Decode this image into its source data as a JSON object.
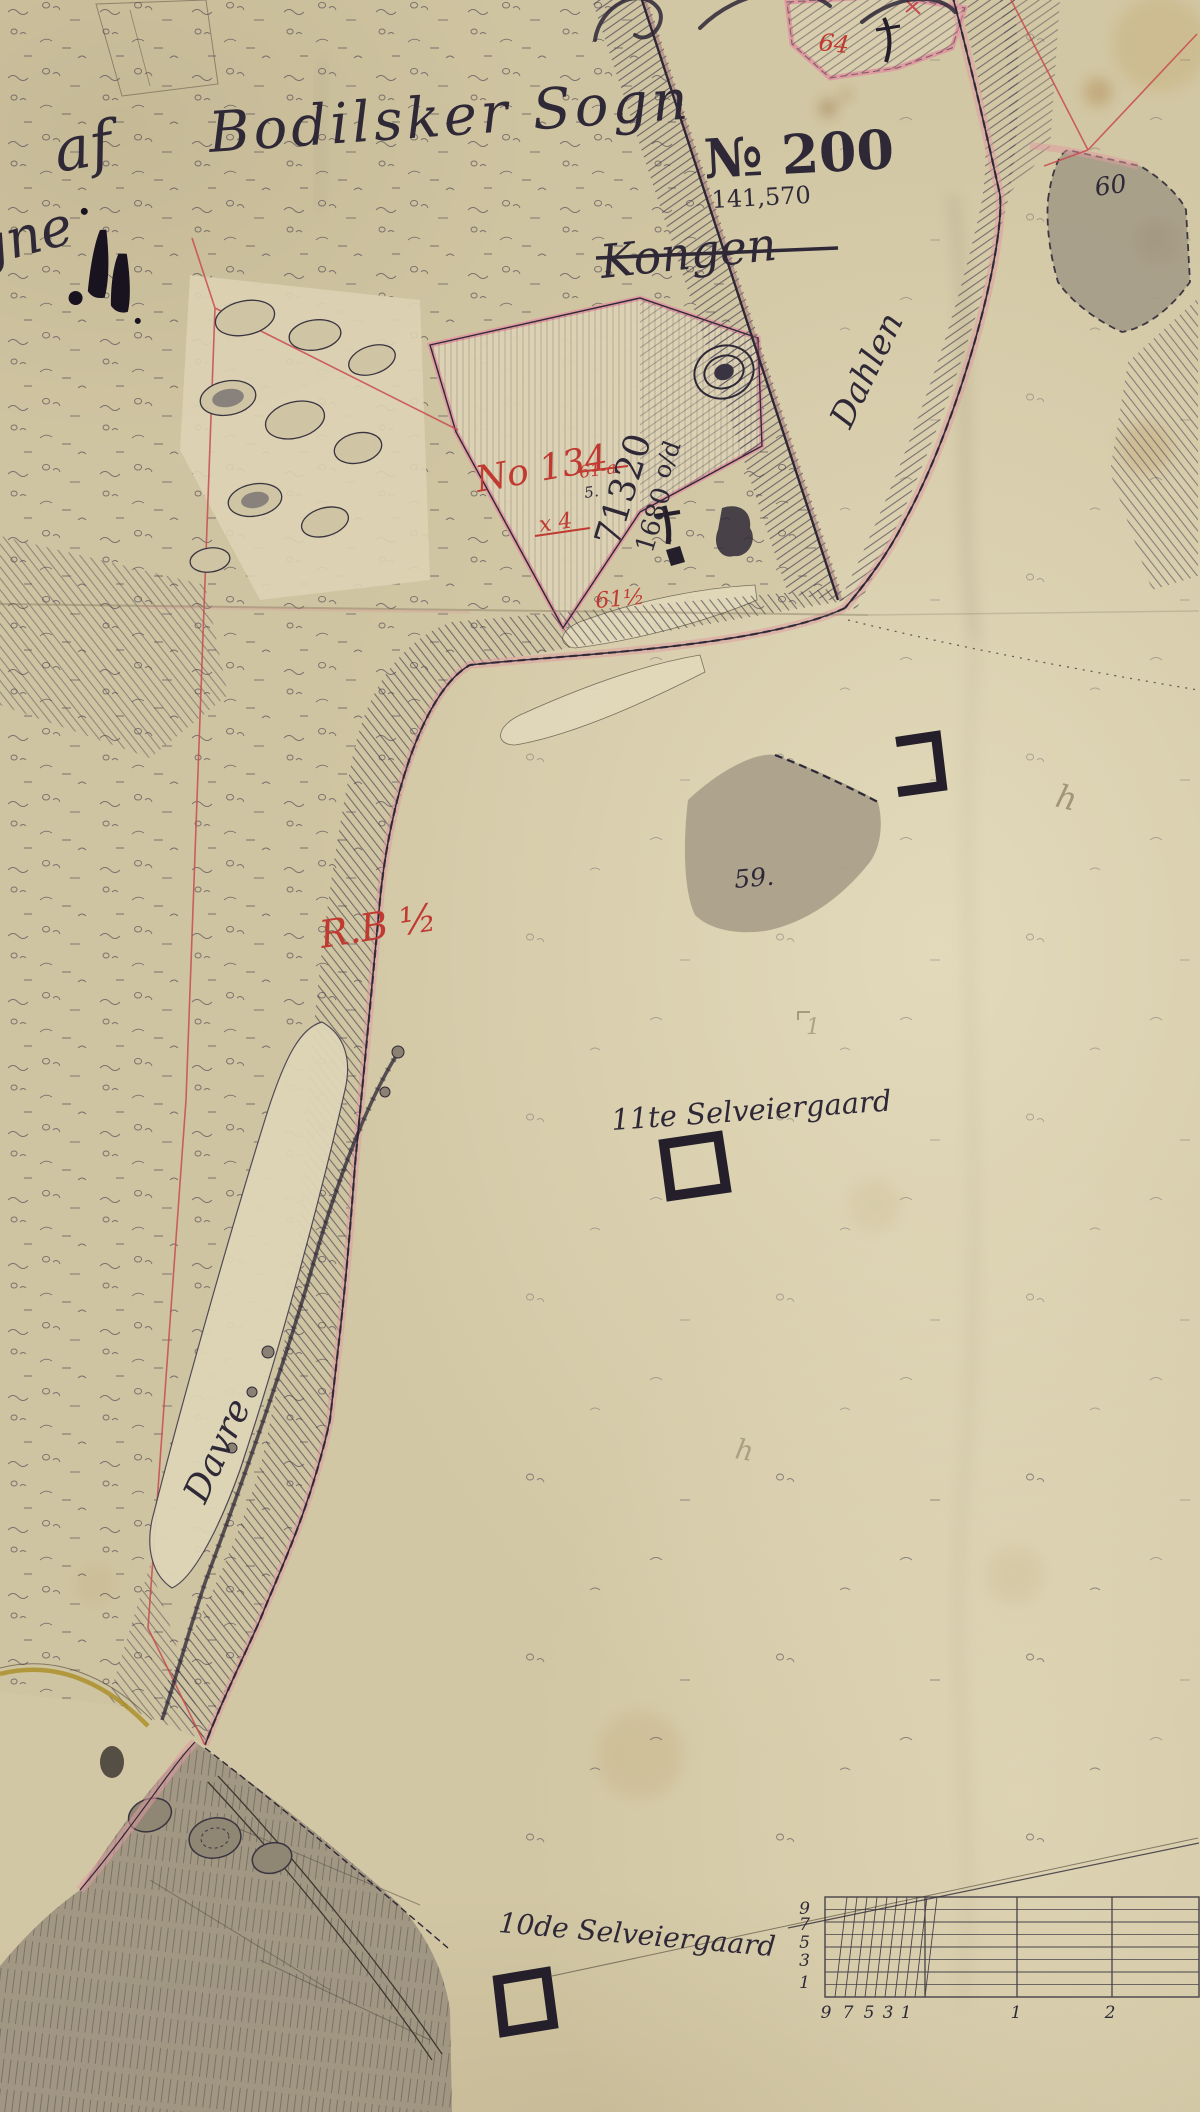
{
  "map": {
    "title": {
      "af": "af",
      "parish": "Bodilsker Sogn",
      "matr_no": "№ 200",
      "area": "141,570",
      "owner_struck": "Kongen",
      "edge_fragment": "gne"
    },
    "places": {
      "road": "Dahlen",
      "strip": "Davre",
      "farm_11": "11te Selveiergaard",
      "farm_10": "10de Selveiergaard"
    },
    "parcels": {
      "no134": "No 134",
      "no134_sub": "61-a",
      "no134_note5": "5.",
      "survey_a": "71320",
      "survey_b": "1680",
      "frac": "o/d",
      "red_x4": "x 4",
      "red_61half": "61½",
      "red_64": "64",
      "red_rb": "R.B ½",
      "gray_59": "59.",
      "gray_60": "60"
    },
    "pencil": {
      "h_upper": "h",
      "h_lower": "h",
      "one": "1"
    },
    "scale_bar": {
      "left_labels": [
        "9",
        "7",
        "5",
        "3",
        "1"
      ],
      "bottom_labels": [
        "9",
        "7",
        "5",
        "3",
        "1"
      ],
      "major_labels": [
        "1",
        "2"
      ]
    },
    "colors": {
      "paper": "#d6cba9",
      "paper_light": "#e2d9bc",
      "ink": "#2e2837",
      "red": "#b8423c",
      "pink": "#e09aa0",
      "gray_wash": "#a29985",
      "pencil": "#93876c"
    }
  }
}
